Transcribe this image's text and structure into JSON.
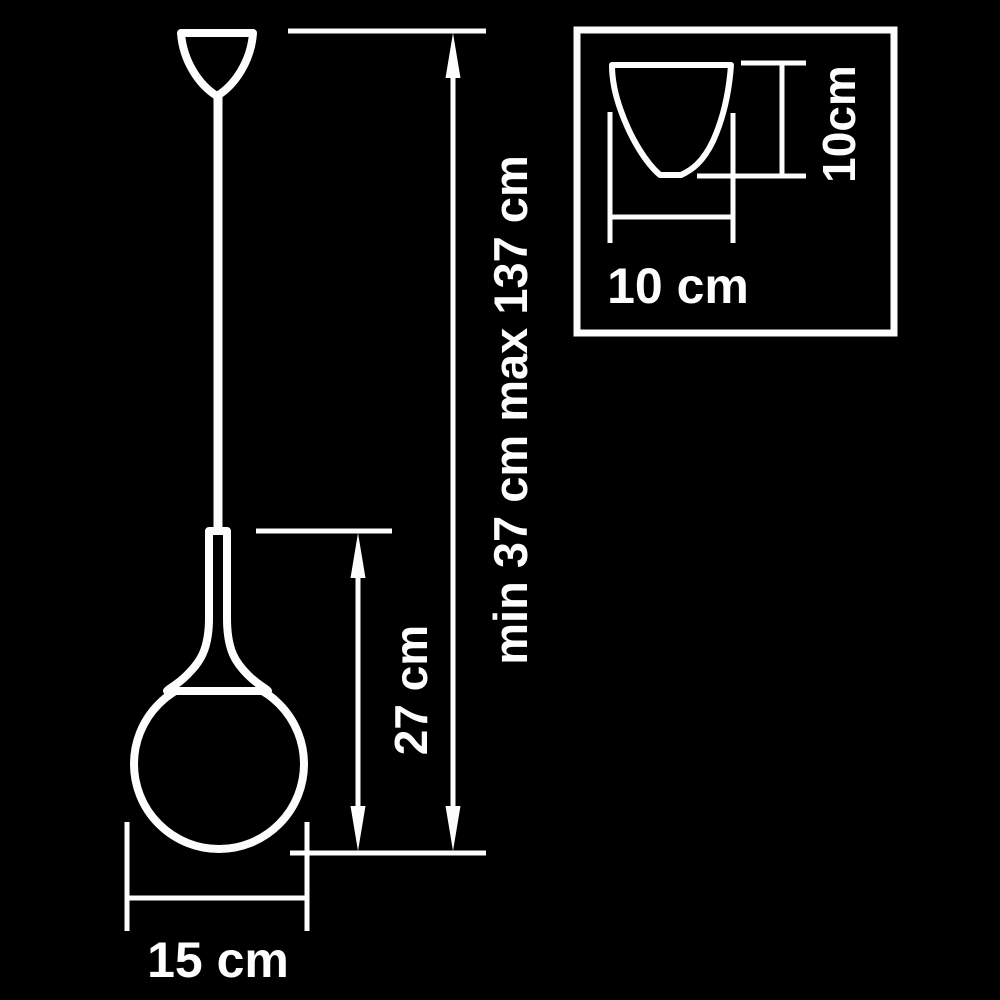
{
  "diagram_title": "pendant-lamp-dimension-diagram",
  "colors": {
    "background": "#000000",
    "line": "#fdfdfd",
    "text": "#fdfdfd"
  },
  "labels": {
    "overall_height": "min 37 cm max 137 cm",
    "body_height": "27 cm",
    "shade_diameter": "15 cm",
    "detail_width": "10 cm",
    "detail_height": "10cm"
  }
}
